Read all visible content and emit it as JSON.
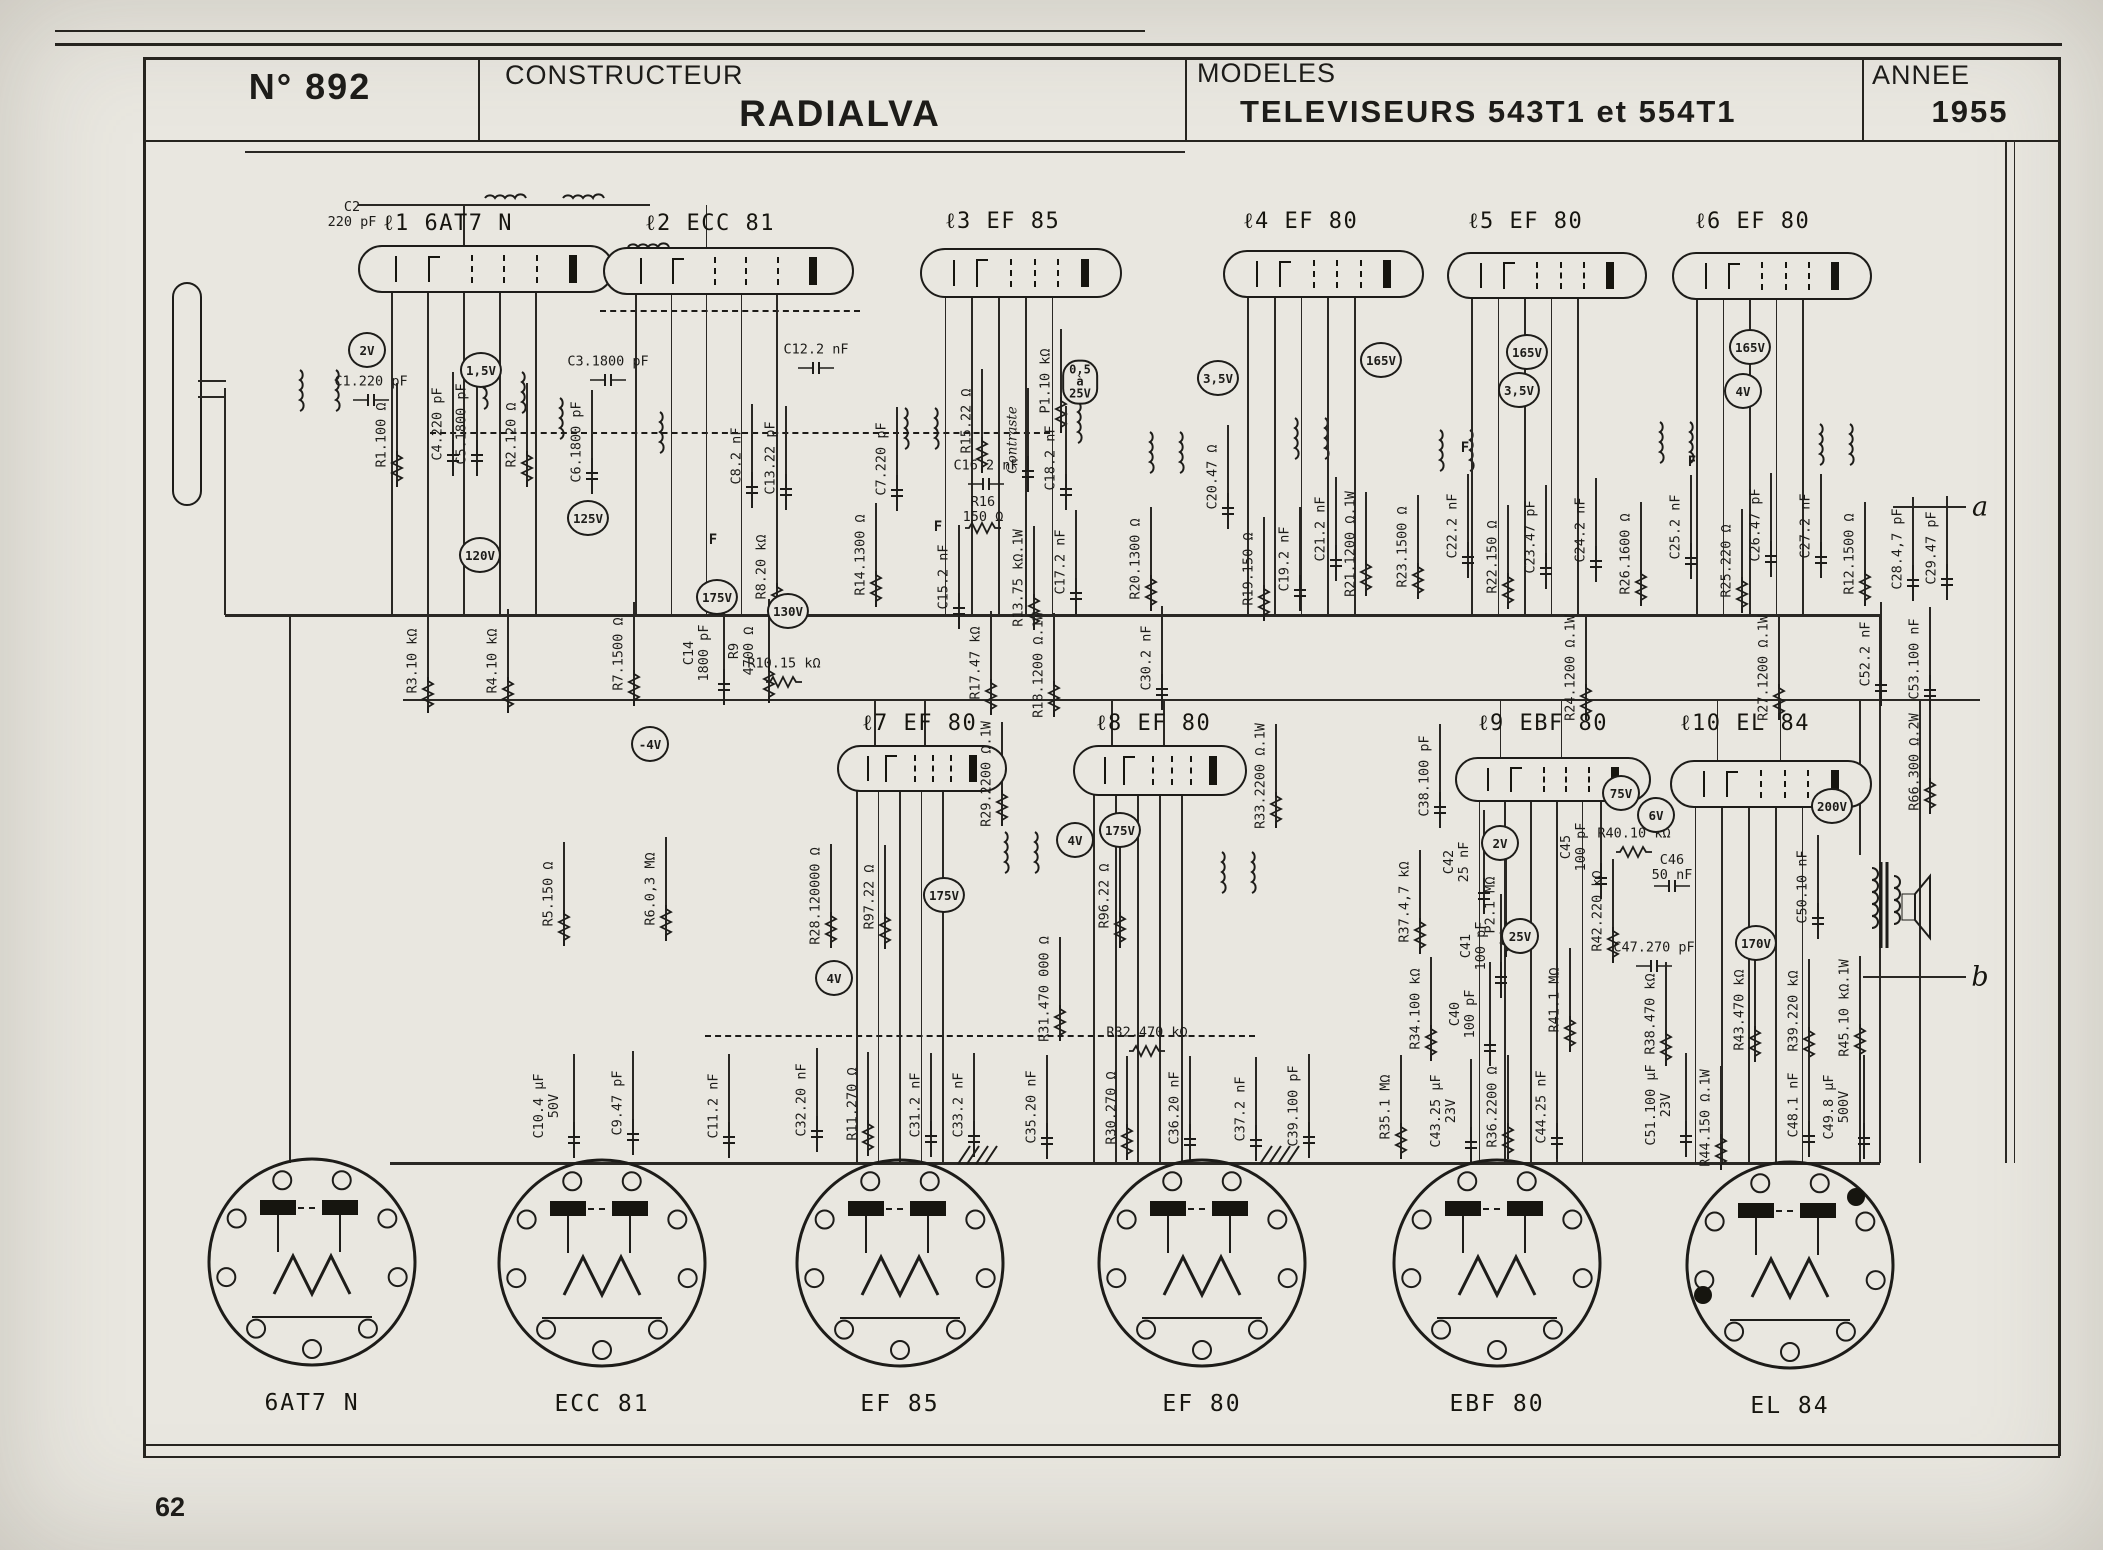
{
  "colors": {
    "paper": "#e9e7e0",
    "ink": "#1d1c19"
  },
  "header": {
    "sheet_no": "N° 892",
    "constructeur_label": "CONSTRUCTEUR",
    "constructeur": "RADIALVA",
    "modeles_label": "MODELES",
    "modeles": "TELEVISEURS 543T1 et 554T1",
    "annee_label": "ANNEE",
    "annee": "1955"
  },
  "page_number": "62",
  "schematic": {
    "tubes": [
      {
        "label": "ℓ1  6AT7  N",
        "x": 358,
        "y": 245,
        "w": 212,
        "h": 44,
        "lx": 383,
        "ly": 210,
        "row": 1
      },
      {
        "label": "ℓ2  ECC 81",
        "x": 603,
        "y": 247,
        "w": 207,
        "h": 44,
        "lx": 645,
        "ly": 210,
        "row": 1
      },
      {
        "label": "ℓ3  EF 85",
        "x": 920,
        "y": 248,
        "w": 158,
        "h": 46,
        "lx": 945,
        "ly": 208,
        "row": 1
      },
      {
        "label": "ℓ4  EF 80",
        "x": 1223,
        "y": 250,
        "w": 157,
        "h": 44,
        "lx": 1243,
        "ly": 208,
        "row": 1
      },
      {
        "label": "ℓ5  EF 80",
        "x": 1447,
        "y": 252,
        "w": 156,
        "h": 43,
        "lx": 1468,
        "ly": 208,
        "row": 1
      },
      {
        "label": "ℓ6  EF 80",
        "x": 1672,
        "y": 252,
        "w": 156,
        "h": 44,
        "lx": 1695,
        "ly": 208,
        "row": 1
      },
      {
        "label": "ℓ7  EF 80",
        "x": 837,
        "y": 745,
        "w": 126,
        "h": 43,
        "lx": 862,
        "ly": 710,
        "row": 2
      },
      {
        "label": "ℓ8  EF 80",
        "x": 1073,
        "y": 745,
        "w": 130,
        "h": 47,
        "lx": 1096,
        "ly": 710,
        "row": 2
      },
      {
        "label": "ℓ9  EBF 80",
        "x": 1455,
        "y": 757,
        "w": 152,
        "h": 41,
        "lx": 1478,
        "ly": 710,
        "row": 2
      },
      {
        "label": "ℓ10 EL 84",
        "x": 1670,
        "y": 760,
        "w": 158,
        "h": 44,
        "lx": 1680,
        "ly": 710,
        "row": 2
      }
    ],
    "components": [
      [
        "C2",
        352,
        215,
        "h",
        "220 pF"
      ],
      [
        "C1.220 pF",
        371,
        382,
        "h"
      ],
      [
        "R1.100 Ω",
        382,
        435,
        "v"
      ],
      [
        "C4.220 pF",
        438,
        424,
        "v"
      ],
      [
        "C5.1800 pF",
        462,
        424,
        "v"
      ],
      [
        "R2.120 Ω",
        512,
        435,
        "v"
      ],
      [
        "C3.1800 pF",
        608,
        362,
        "h"
      ],
      [
        "C6.1800 pF",
        577,
        442,
        "v"
      ],
      [
        "C8.2 nF",
        737,
        456,
        "v"
      ],
      [
        "C13.22 pF",
        771,
        458,
        "v"
      ],
      [
        "C12.2 nF",
        816,
        350,
        "h"
      ],
      [
        "C7.220 pF",
        882,
        459,
        "v"
      ],
      [
        "R8.20 kΩ",
        762,
        567,
        "v"
      ],
      [
        "R14.1300 Ω",
        861,
        555,
        "v"
      ],
      [
        "C15.2 nF",
        944,
        577,
        "v"
      ],
      [
        "R16",
        983,
        510,
        "h",
        "150 Ω"
      ],
      [
        "R15.22 Ω",
        967,
        421,
        "v"
      ],
      [
        "C16.2 nF",
        986,
        466,
        "h"
      ],
      [
        "Contraste",
        1013,
        440,
        "v"
      ],
      [
        "P1.10 kΩ",
        1046,
        381,
        "v"
      ],
      [
        "C18.2 nF",
        1051,
        458,
        "v"
      ],
      [
        "R13.75 kΩ.1W",
        1019,
        578,
        "v"
      ],
      [
        "C17.2 nF",
        1061,
        562,
        "v"
      ],
      [
        "R17.47 kΩ",
        976,
        663,
        "v"
      ],
      [
        "R18.1200 Ω.1W",
        1039,
        665,
        "v"
      ],
      [
        "C30.2 nF",
        1147,
        658,
        "v"
      ],
      [
        "R3.10 kΩ",
        413,
        661,
        "v"
      ],
      [
        "R4.10 kΩ",
        493,
        661,
        "v"
      ],
      [
        "R7.1500 Ω",
        619,
        654,
        "v"
      ],
      [
        "C14",
        697,
        653,
        "v",
        "1800 pF"
      ],
      [
        "R9",
        742,
        651,
        "v",
        "4700 Ω"
      ],
      [
        "R10.15 kΩ",
        784,
        664,
        "h"
      ],
      [
        "R20.1300 Ω",
        1136,
        559,
        "v"
      ],
      [
        "C20.47 Ω",
        1213,
        477,
        "v"
      ],
      [
        "R19.150 Ω",
        1249,
        569,
        "v"
      ],
      [
        "C19.2 nF",
        1285,
        559,
        "v"
      ],
      [
        "C21.2 nF",
        1321,
        529,
        "v"
      ],
      [
        "R21.1200 Ω.1W",
        1351,
        544,
        "v"
      ],
      [
        "R23.1500 Ω",
        1403,
        547,
        "v"
      ],
      [
        "C22.2 nF",
        1453,
        526,
        "v"
      ],
      [
        "R22.150 Ω",
        1493,
        557,
        "v"
      ],
      [
        "C23.47 pF",
        1531,
        537,
        "v"
      ],
      [
        "C24.2 nF",
        1581,
        530,
        "v"
      ],
      [
        "R26.1600 Ω",
        1626,
        554,
        "v"
      ],
      [
        "C25.2 nF",
        1676,
        527,
        "v"
      ],
      [
        "R25.220 Ω",
        1727,
        561,
        "v"
      ],
      [
        "C26.47 pF",
        1756,
        525,
        "v"
      ],
      [
        "C27.2 nF",
        1806,
        526,
        "v"
      ],
      [
        "R12.1500 Ω",
        1850,
        554,
        "v"
      ],
      [
        "C28.4,7 pF",
        1898,
        549,
        "v"
      ],
      [
        "C29.47 pF",
        1932,
        548,
        "v"
      ],
      [
        "C52.2 nF",
        1866,
        654,
        "v"
      ],
      [
        "C53.100 nF",
        1915,
        659,
        "v"
      ],
      [
        "R24.1200 Ω.1W",
        1571,
        668,
        "v"
      ],
      [
        "R27.1200 Ω.1W",
        1764,
        668,
        "v"
      ],
      [
        "R66.300 Ω.2W",
        1915,
        762,
        "v"
      ],
      [
        "R33.2200 Ω.1W",
        1261,
        776,
        "v"
      ],
      [
        "C38.100 pF",
        1425,
        776,
        "v"
      ],
      [
        "R29.2200 Ω.1W",
        987,
        774,
        "v"
      ],
      [
        "R28.120000 Ω",
        816,
        896,
        "v"
      ],
      [
        "R97.22 Ω",
        870,
        897,
        "v"
      ],
      [
        "R5.150 Ω",
        549,
        894,
        "v"
      ],
      [
        "R6.0,3 MΩ",
        651,
        889,
        "v"
      ],
      [
        "R31.470 000 Ω",
        1045,
        989,
        "v"
      ],
      [
        "R96.22 Ω",
        1105,
        896,
        "v"
      ],
      [
        "R32.470 kΩ",
        1147,
        1033,
        "h"
      ],
      [
        "R30.270 Ω",
        1112,
        1108,
        "v"
      ],
      [
        "C35.20 nF",
        1032,
        1107,
        "v"
      ],
      [
        "C36.20 nF",
        1175,
        1108,
        "v"
      ],
      [
        "C37.2 nF",
        1241,
        1109,
        "v"
      ],
      [
        "C39.100 pF",
        1294,
        1106,
        "v"
      ],
      [
        "R35.1 MΩ",
        1386,
        1107,
        "v"
      ],
      [
        "R34.100 kΩ",
        1416,
        1009,
        "v"
      ],
      [
        "C40",
        1463,
        1014,
        "v",
        "100 pF"
      ],
      [
        "C43.25 μF",
        1444,
        1111,
        "v",
        "23V"
      ],
      [
        "R36.2200 Ω",
        1493,
        1107,
        "v"
      ],
      [
        "C44.25 nF",
        1542,
        1107,
        "v"
      ],
      [
        "R41.1 MΩ",
        1555,
        1000,
        "v"
      ],
      [
        "C42",
        1457,
        862,
        "v",
        "25 nF"
      ],
      [
        "R37.4,7 kΩ",
        1405,
        902,
        "v"
      ],
      [
        "P2.1 MΩ",
        1491,
        905,
        "v"
      ],
      [
        "C41",
        1474,
        946,
        "v",
        "100 pF"
      ],
      [
        "C45",
        1574,
        847,
        "v",
        "100 pF"
      ],
      [
        "R42.220 kΩ",
        1598,
        911,
        "v"
      ],
      [
        "R40.10 kΩ",
        1634,
        834,
        "h"
      ],
      [
        "C46",
        1672,
        868,
        "h",
        "50 nF"
      ],
      [
        "C47.270 pF",
        1654,
        948,
        "h"
      ],
      [
        "R38.470 kΩ",
        1651,
        1014,
        "v"
      ],
      [
        "C51.100 μF",
        1659,
        1105,
        "v",
        "23V"
      ],
      [
        "R44.150 Ω.1W",
        1706,
        1118,
        "v"
      ],
      [
        "R43.470 kΩ",
        1740,
        1010,
        "v"
      ],
      [
        "R39.220 kΩ",
        1794,
        1011,
        "v"
      ],
      [
        "R45.10 kΩ.1W",
        1845,
        1008,
        "v"
      ],
      [
        "C48.1 nF",
        1794,
        1105,
        "v"
      ],
      [
        "C49.8 μF",
        1837,
        1107,
        "v",
        "500V"
      ],
      [
        "C50.10 nF",
        1803,
        887,
        "v"
      ],
      [
        "C10.4 μF",
        547,
        1106,
        "v",
        "50V"
      ],
      [
        "C9.47 pF",
        618,
        1103,
        "v"
      ],
      [
        "C11.2 nF",
        714,
        1106,
        "v"
      ],
      [
        "C32.20 nF",
        802,
        1100,
        "v"
      ],
      [
        "R11.270 Ω",
        853,
        1104,
        "v"
      ],
      [
        "C31.2 nF",
        916,
        1105,
        "v"
      ],
      [
        "C33.2 nF",
        959,
        1105,
        "v"
      ]
    ],
    "voltages": [
      [
        "2V",
        367,
        350
      ],
      [
        "1,5V",
        481,
        370
      ],
      [
        "120V",
        480,
        555
      ],
      [
        "125V",
        588,
        518
      ],
      [
        "175V",
        717,
        597
      ],
      [
        "130V",
        788,
        611
      ],
      [
        "3,5V",
        1218,
        378
      ],
      [
        "165V",
        1381,
        360
      ],
      [
        "165V",
        1527,
        352
      ],
      [
        "3,5V",
        1519,
        390
      ],
      [
        "165V",
        1750,
        347
      ],
      [
        "4V",
        1743,
        391
      ],
      [
        "-4V",
        650,
        744
      ],
      [
        "175V",
        944,
        895
      ],
      [
        "4V",
        1075,
        840
      ],
      [
        "175V",
        1120,
        830
      ],
      [
        "4V",
        834,
        978
      ],
      [
        "2V",
        1500,
        843
      ],
      [
        "75V",
        1621,
        793
      ],
      [
        "6V",
        1656,
        815
      ],
      [
        "25V",
        1520,
        936
      ],
      [
        "170V",
        1756,
        943
      ],
      [
        "200V",
        1832,
        806
      ]
    ],
    "voltage_pill": {
      "lines": [
        "0,5",
        "à",
        "25V"
      ],
      "x": 1080,
      "y": 382
    },
    "f_labels": [
      [
        713,
        540
      ],
      [
        938,
        527
      ],
      [
        1465,
        448
      ],
      [
        1692,
        462
      ]
    ],
    "terminals": [
      {
        "label": "a",
        "x": 1980,
        "y": 507
      },
      {
        "label": "b",
        "x": 1980,
        "y": 977
      }
    ],
    "sockets": [
      {
        "label": "6AT7 N",
        "cx": 312,
        "cy": 1262
      },
      {
        "label": "ECC 81",
        "cx": 602,
        "cy": 1263
      },
      {
        "label": "EF 85",
        "cx": 900,
        "cy": 1263,
        "hatch": true
      },
      {
        "label": "EF 80",
        "cx": 1202,
        "cy": 1263,
        "hatch": true
      },
      {
        "label": "EBF 80",
        "cx": 1497,
        "cy": 1263
      },
      {
        "label": "EL 84",
        "cx": 1790,
        "cy": 1265,
        "dot": true
      }
    ],
    "wires": [
      [
        245,
        152,
        1185,
        152,
        1.5
      ],
      [
        358,
        205,
        650,
        205,
        1.5
      ],
      [
        225,
        615,
        1880,
        615,
        3
      ],
      [
        403,
        700,
        1980,
        700,
        2
      ],
      [
        390,
        1163,
        1880,
        1163,
        3
      ],
      [
        225,
        388,
        225,
        615,
        2
      ],
      [
        198,
        381,
        226,
        381,
        1.5
      ],
      [
        198,
        397,
        226,
        397,
        1.5
      ],
      [
        290,
        615,
        290,
        1163,
        2
      ],
      [
        1880,
        615,
        1880,
        1163,
        2
      ],
      [
        1920,
        700,
        1920,
        1163,
        1.5
      ],
      [
        2006,
        140,
        2006,
        1163,
        2
      ],
      [
        2014,
        140,
        2014,
        1163,
        1
      ],
      [
        1893,
        507,
        1966,
        507,
        1.5
      ],
      [
        1863,
        977,
        1966,
        977,
        1.5
      ],
      [
        1860,
        700,
        1860,
        855,
        1.5
      ],
      [
        1860,
        965,
        1860,
        1163,
        1.5
      ]
    ],
    "dashed_wires": [
      [
        600,
        310,
        860,
        310
      ],
      [
        430,
        432,
        1050,
        432
      ],
      [
        705,
        1035,
        1255,
        1035
      ]
    ],
    "coils_v": [
      [
        300,
        390
      ],
      [
        336,
        390
      ],
      [
        484,
        388
      ],
      [
        522,
        392
      ],
      [
        560,
        418
      ],
      [
        660,
        432
      ],
      [
        905,
        428
      ],
      [
        935,
        428
      ],
      [
        1078,
        422
      ],
      [
        1150,
        452
      ],
      [
        1180,
        452
      ],
      [
        1295,
        438
      ],
      [
        1325,
        438
      ],
      [
        1440,
        450
      ],
      [
        1470,
        450
      ],
      [
        1660,
        442
      ],
      [
        1690,
        442
      ],
      [
        1820,
        444
      ],
      [
        1850,
        444
      ],
      [
        1005,
        852
      ],
      [
        1035,
        852
      ],
      [
        1222,
        872
      ],
      [
        1252,
        872
      ]
    ],
    "coils_h": [
      [
        505,
        198
      ],
      [
        583,
        198
      ],
      [
        648,
        247
      ]
    ]
  }
}
